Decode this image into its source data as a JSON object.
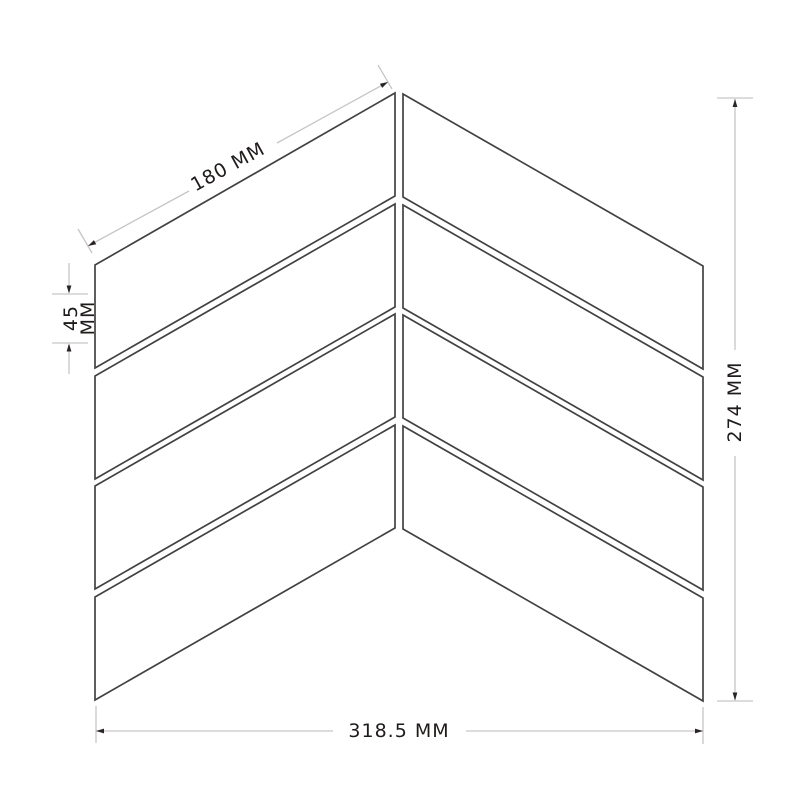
{
  "diagram": {
    "dimensions": {
      "tile_length": {
        "label": "180 MM"
      },
      "tile_width": {
        "value_line": "45",
        "unit_line": "MM"
      },
      "panel_height": {
        "label": "274 MM"
      },
      "panel_width": {
        "label": "318.5 MM"
      }
    },
    "colors": {
      "background": "#ffffff",
      "tile_outline": "#424242",
      "dimension_line": "#c6c6c6",
      "arrowhead": "#2a2524",
      "label_text": "#1f1b1a"
    }
  }
}
